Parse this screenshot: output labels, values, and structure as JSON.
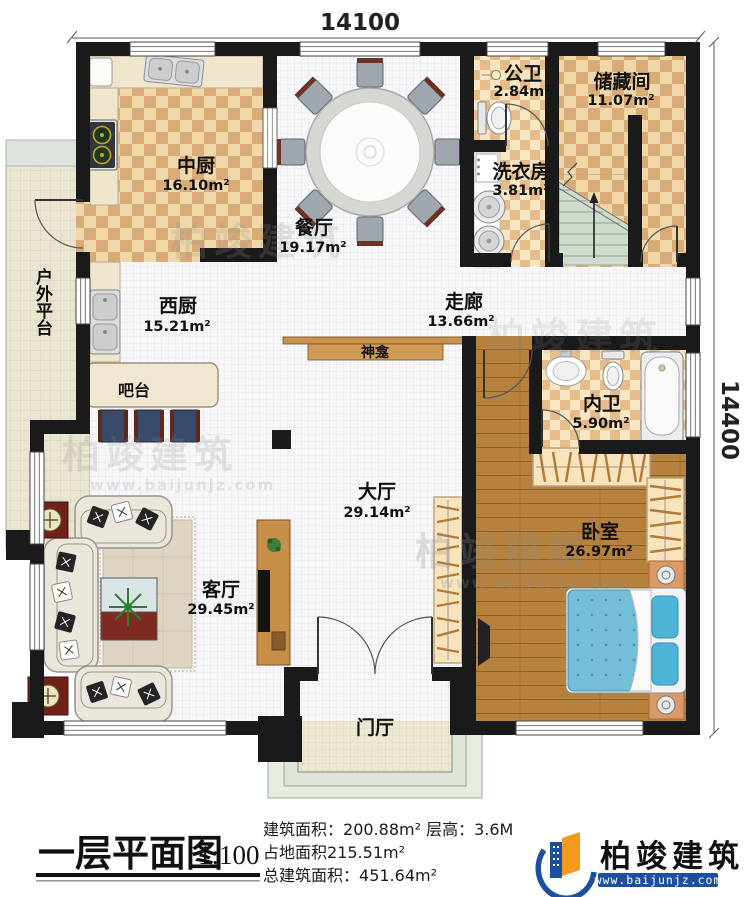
{
  "plan": {
    "dimensions": {
      "width_mm": "14100",
      "height_mm": "14400"
    },
    "rooms": {
      "zhongchu": {
        "name": "中厨",
        "area": "16.10m²"
      },
      "canting": {
        "name": "餐厅",
        "area": "19.17m²"
      },
      "gongwei": {
        "name": "公卫",
        "area": "2.84m²"
      },
      "chucangjian": {
        "name": "储藏间",
        "area": "11.07m²"
      },
      "xiyifang": {
        "name": "洗衣房",
        "area": "3.81m²"
      },
      "xichu": {
        "name": "西厨",
        "area": "15.21m²"
      },
      "zoulang": {
        "name": "走廊",
        "area": "13.66m²"
      },
      "neiwei": {
        "name": "内卫",
        "area": "5.90m²"
      },
      "dating": {
        "name": "大厅",
        "area": "29.14m²"
      },
      "woshi": {
        "name": "卧室",
        "area": "26.97m²"
      },
      "keting": {
        "name": "客厅",
        "area": "29.45m²"
      },
      "menting": {
        "name": "门厅"
      },
      "huwaipingtai": {
        "name": "户外平台"
      },
      "batai": {
        "name": "吧台"
      },
      "shenkan": {
        "name": "神龛"
      }
    }
  },
  "title_block": {
    "title": "一层平面图",
    "scale": "1:100",
    "stats": {
      "building_area_label": "建筑面积：",
      "building_area": "200.88m²",
      "floor_height_label": "  层高：",
      "floor_height": "3.6M",
      "land_area_label": "占地面积",
      "land_area": "215.51m²",
      "total_area_label": "总建筑面积：",
      "total_area": "451.64m²"
    }
  },
  "logo": {
    "name": "柏竣建筑",
    "url": "www.baijunjz.com"
  },
  "watermark": {
    "name": "柏竣建筑",
    "url": "www.baijunjz.com"
  },
  "colors": {
    "wall": "#1a1a1a",
    "checker_light": "#f0d7a8",
    "checker_dark": "#d9ab77",
    "wood": "#b5813d",
    "bed": "#74beda",
    "stair": "#cfdbce",
    "logo_blue": "#1c4f9c",
    "logo_orange": "#f29a1d"
  }
}
